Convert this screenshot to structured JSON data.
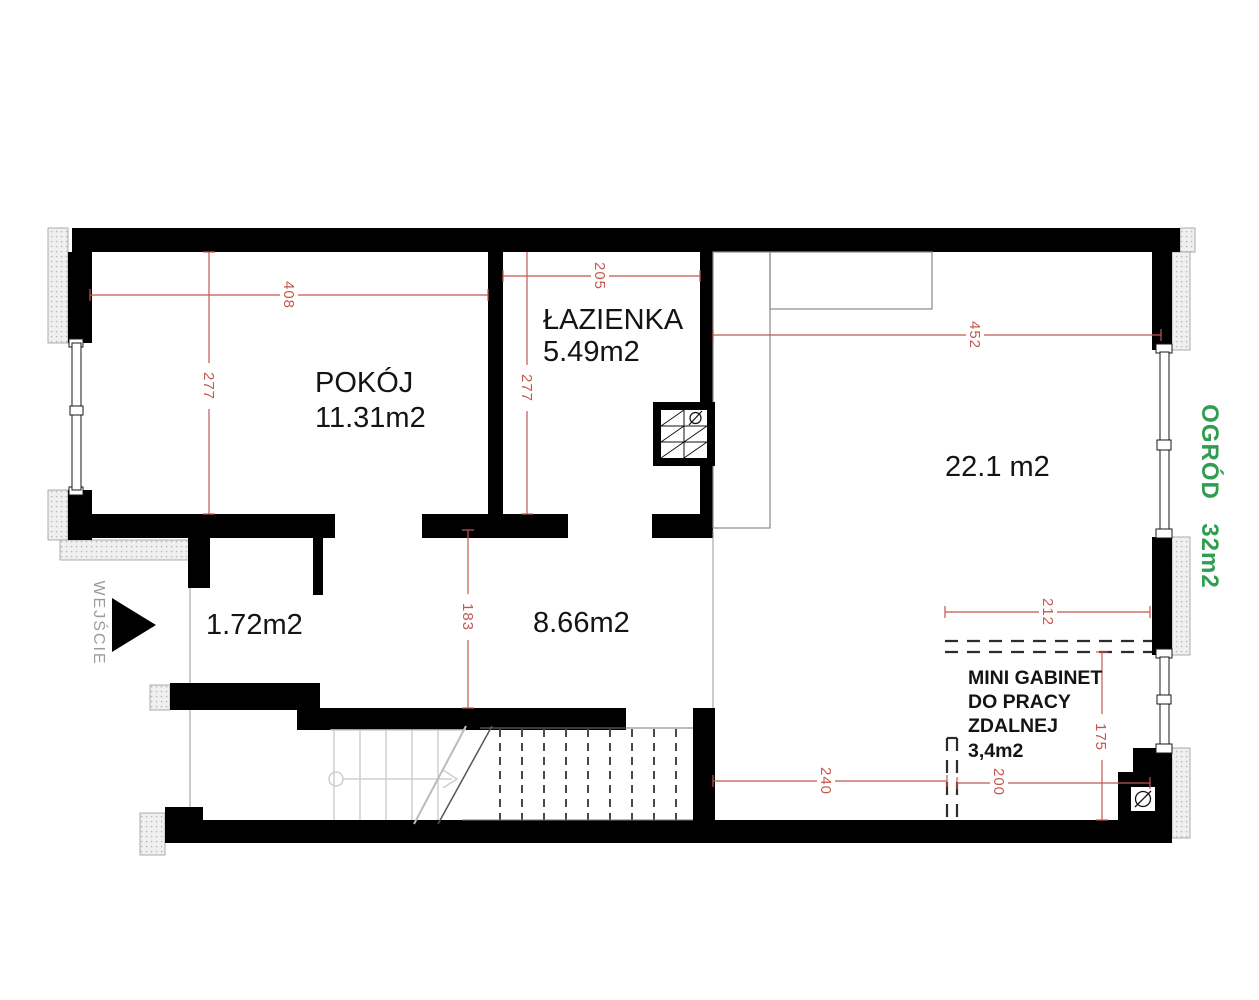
{
  "title": "Apartment floor plan",
  "colors": {
    "wall": "#000000",
    "dimension": "#c2584f",
    "garden_label": "#2f9e50",
    "entrance_label": "#9b9b9b",
    "room_label": "#141414"
  },
  "rooms": {
    "pokoj": {
      "name": "POKÓJ",
      "area": "11.31m2"
    },
    "lazienka": {
      "name": "ŁAZIENKA",
      "area": "5.49m2"
    },
    "living": {
      "area": "22.1 m2"
    },
    "vestibule": {
      "area": "1.72m2"
    },
    "hall": {
      "area": "8.66m2"
    },
    "office": {
      "name_line1": "MINI GABINET",
      "name_line2": "DO PRACY",
      "name_line3": "ZDALNEJ",
      "area": "3,4m2"
    }
  },
  "garden": {
    "label": "OGRÓD",
    "area": "32m2"
  },
  "entrance": {
    "label": "WEJŚCIE"
  },
  "dimensions": {
    "pokoj_width": "408",
    "pokoj_depth": "277",
    "lazienka_width": "205",
    "lazienka_depth": "277",
    "living_width": "452",
    "hall_depth": "183",
    "hall_width": "240",
    "office_bottom_width": "200",
    "office_top_width": "212",
    "office_depth": "175"
  }
}
